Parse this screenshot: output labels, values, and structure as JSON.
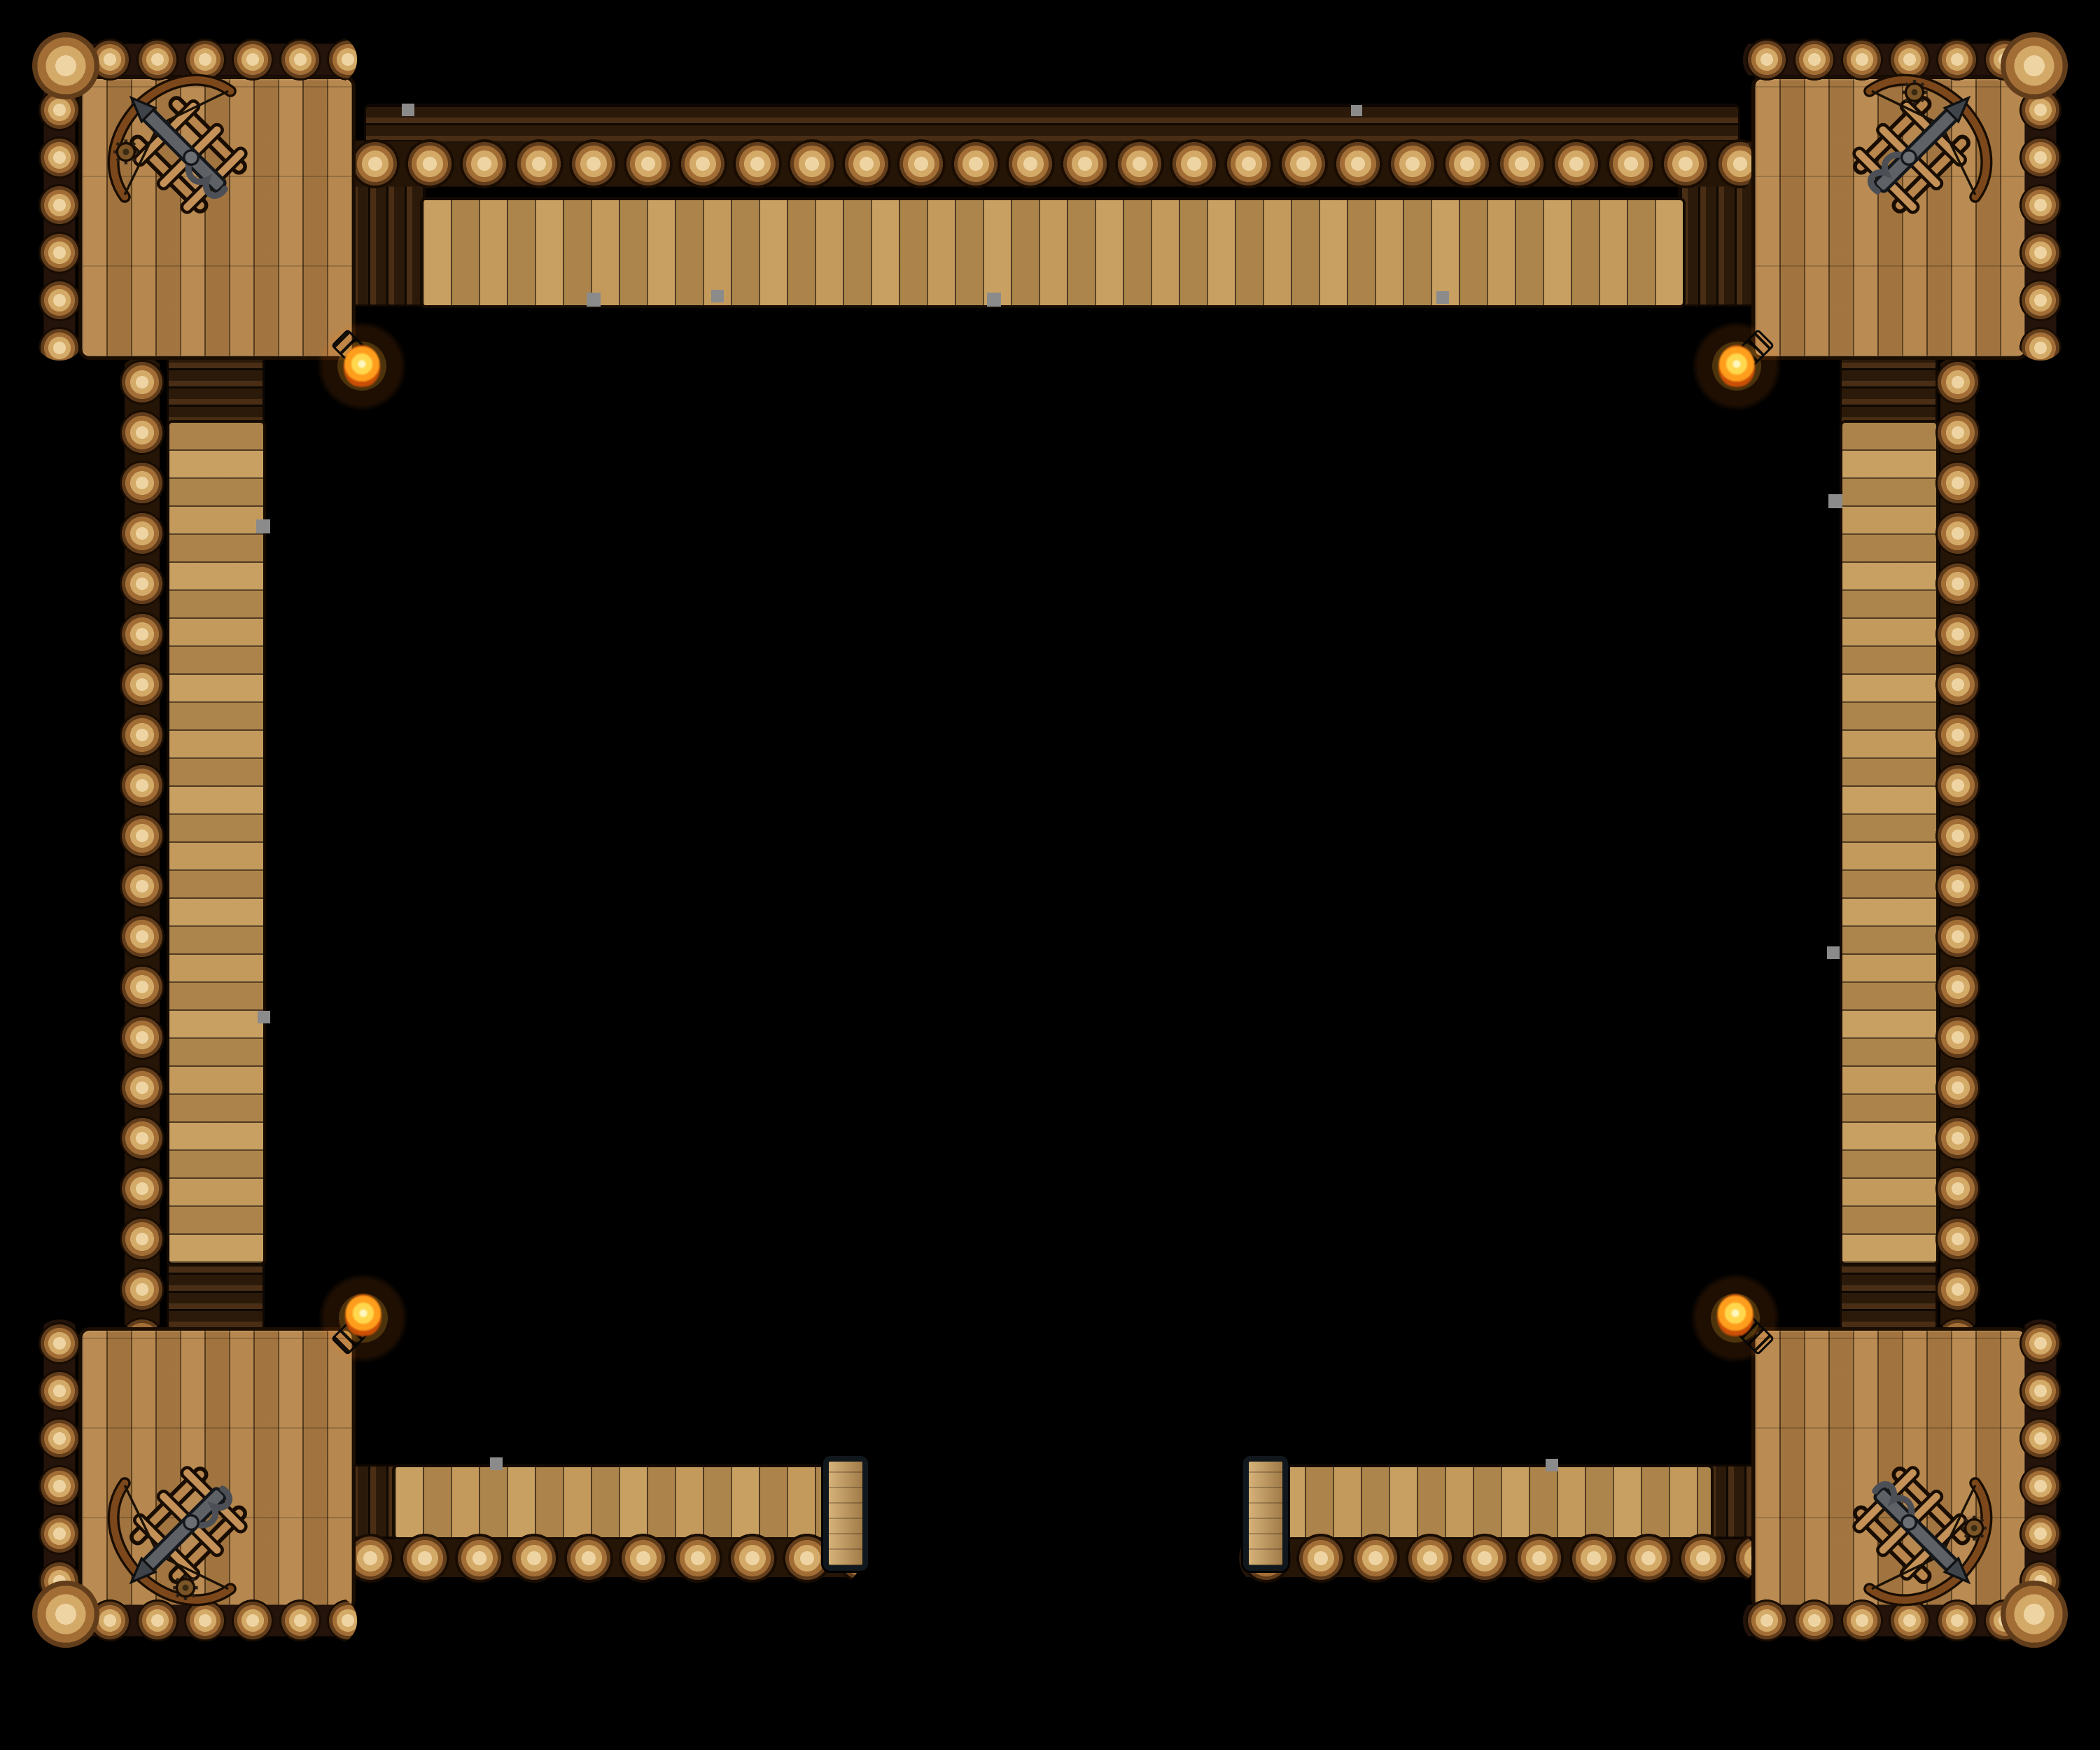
{
  "scene": {
    "background_color": "#000000",
    "map_type": "top-down fantasy battle map",
    "structure": "square timber palisade fort perimeter with plank walkways, four corner watchtowers and an open south gate",
    "towers": [
      {
        "id": "top-left",
        "label": "Top-left corner watchtower platform",
        "ballista_label": "Ballista aimed northwest",
        "torch_label": "Lit torch at inner southeast corner"
      },
      {
        "id": "top-right",
        "label": "Top-right corner watchtower platform",
        "ballista_label": "Ballista aimed northeast",
        "torch_label": "Lit torch at inner southwest corner"
      },
      {
        "id": "bottom-left",
        "label": "Bottom-left corner watchtower platform",
        "ballista_label": "Ballista aimed southwest",
        "torch_label": "Lit torch at inner northeast corner"
      },
      {
        "id": "bottom-right",
        "label": "Bottom-right corner watchtower platform",
        "ballista_label": "Ballista aimed southeast",
        "torch_label": "Lit torch at inner northwest corner"
      }
    ],
    "walls": [
      {
        "id": "north",
        "label": "North palisade wall: log rampart with hanging plank walkway"
      },
      {
        "id": "west",
        "label": "West palisade wall: log rampart with plank walkway"
      },
      {
        "id": "east",
        "label": "East palisade wall: log rampart with plank walkway"
      },
      {
        "id": "south-west",
        "label": "South-west palisade wall segment ending at gate post"
      },
      {
        "id": "south-east",
        "label": "South-east palisade wall segment ending at gate post"
      }
    ],
    "gate": {
      "label": "Open south gate between two framed gate posts"
    },
    "counts": {
      "towers": 4,
      "ballistas": 4,
      "torches": 4,
      "gate_posts": 2,
      "wall_segments": 5
    },
    "palette": {
      "background": "#000000",
      "plank_light": "#c49a5e",
      "plank_mid": "#b28249",
      "plank_shadow": "#6f4a22",
      "log_end_light": "#eed4a2",
      "log_end_mid": "#d4aa68",
      "log_ring_dark": "#623d1b",
      "dark_timber": "#2d1b0a",
      "outline": "#190d02",
      "metal": "#5e6267",
      "flame_core": "#fff7c0",
      "flame_mid": "#ffd84e",
      "flame_outer": "#ff9d1c"
    }
  }
}
